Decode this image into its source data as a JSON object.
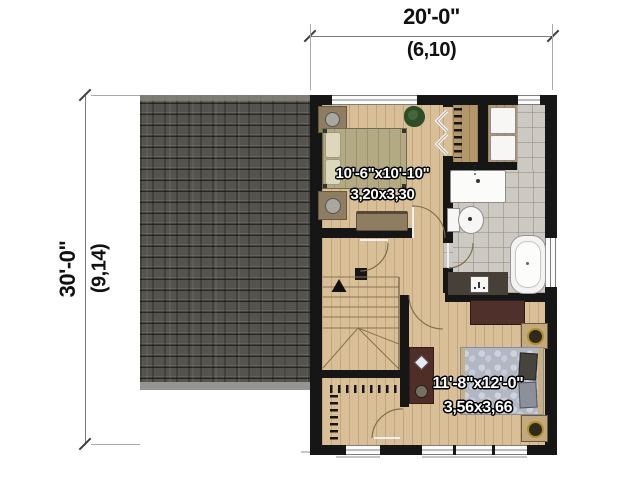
{
  "dimensions": {
    "top": {
      "imperial": "20'-0\"",
      "metric": "(6,10)"
    },
    "left": {
      "imperial": "30'-0\"",
      "metric": "(9,14)"
    }
  },
  "rooms": {
    "bedroom_top": {
      "imperial": "10'-6\"x10'-10\"",
      "metric": "3,20x3,30"
    },
    "bedroom_bottom": {
      "imperial": "11'-8\"x12'-0\"",
      "metric": "3,56x3,66"
    }
  },
  "colors": {
    "roof": "#55534e",
    "wall": "#161616",
    "wood_floor": "#d8bf97",
    "tile_floor": "#ccc8c2",
    "closet_wood": "#b3976b",
    "furniture_dark": "#502d26",
    "bed_top_cover": "#b3aa84",
    "bed_bottom_cover": "#b2b7c4",
    "label_text": "#ffffff",
    "dimension_text": "#111111"
  }
}
